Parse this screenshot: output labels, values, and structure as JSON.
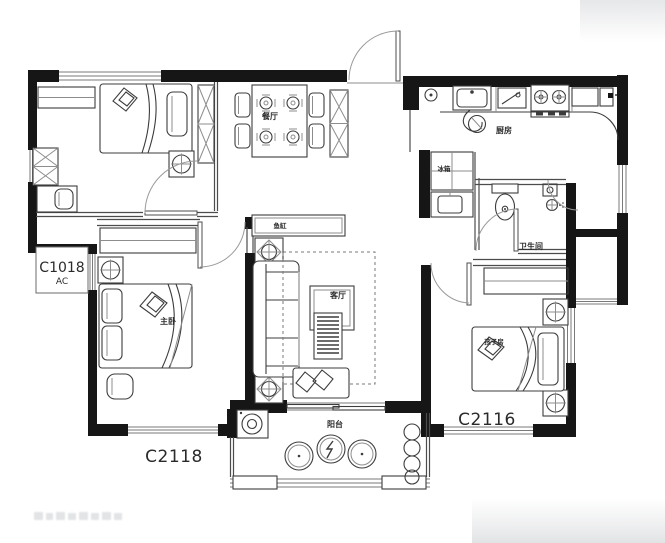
{
  "plan": {
    "room_labels": {
      "dining": "餐厅",
      "kitchen": "厨房",
      "bathroom": "卫生间",
      "living": "客厅",
      "master_bedroom": "主卧",
      "kids_room": "孩子房",
      "balcony": "阳台"
    },
    "fixture_labels": {
      "fish_tank": "鱼缸",
      "fridge": "冰箱"
    },
    "window_codes": {
      "left_window": "C1018",
      "left_window_sub": "AC",
      "master_window": "C2118",
      "kids_window": "C2116"
    },
    "colors": {
      "wall": "#161616",
      "furniture_line": "#3c3c3c",
      "window_line": "#7a7a7a",
      "label_text": "#2b2b2b",
      "background": "#ffffff",
      "edge_shade": "#e6e7e9"
    }
  }
}
